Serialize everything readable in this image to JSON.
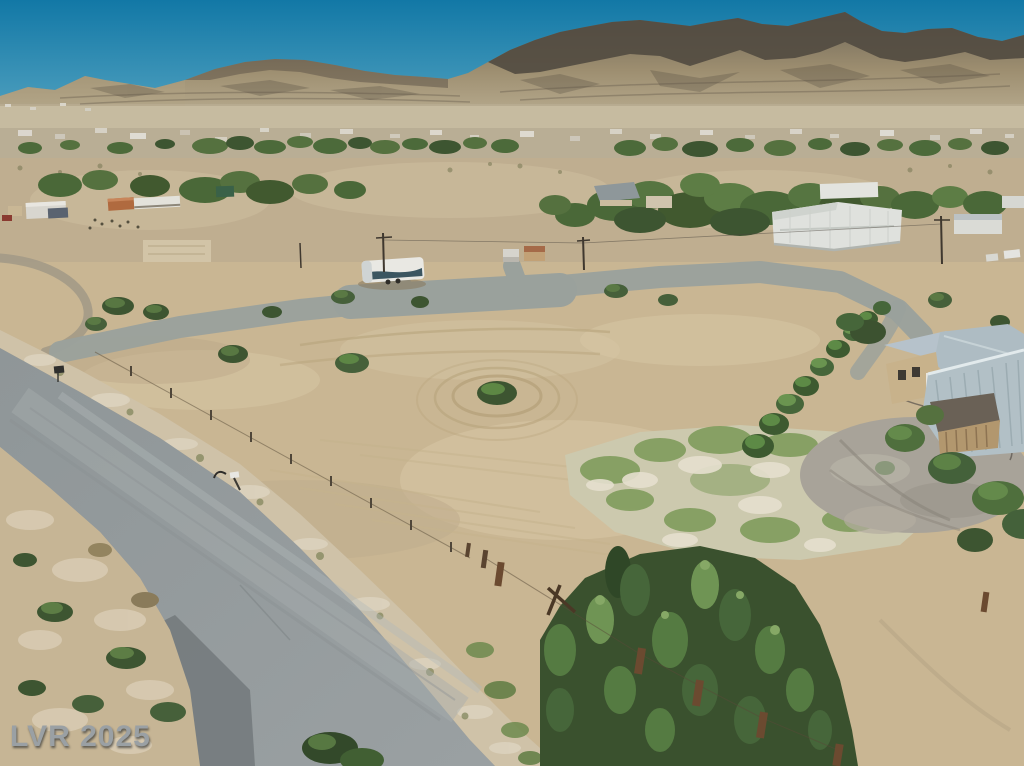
{
  "watermark": {
    "text": "LVR 2025"
  },
  "scene": {
    "colors": {
      "sky-top": "#1278a6",
      "sky-horizon": "#5aa7c3",
      "mountain-top": "#6e6658",
      "mountain-base": "#bdb195",
      "mountain-rock-dark": "#514a40",
      "valley": "#c2b698",
      "town-ground": "#b3a88c",
      "tree-dark": "#3d5531",
      "tree-mid": "#55713f",
      "tree-light": "#6f9254",
      "sand": "#c9b693",
      "sand-light": "#d7c7a6",
      "track": "#b7a37c",
      "pad-gray": "#9aa19c",
      "road": "#9aa0a2",
      "road-dark": "#747b7d",
      "gravel": "#cfc2a8",
      "gravel-light": "#ded5c2",
      "grass": "#7b9a58",
      "grass-ground": "#ccc9ae",
      "rv-white": "#e9e8e3",
      "rv-graphic": "#3b5560",
      "container-rust": "#b06a3f",
      "building-white": "#e0e1dc",
      "warehouse-roof": "#dfe1dd",
      "roof-gray": "#aebcc3",
      "corrugated": "#b2c0c6",
      "wall-tan": "#c8b28b",
      "shed-roof": "#6a6156",
      "shed-wall": "#b2976e",
      "post-brown": "#6b4a30",
      "gravel-yard": "#a8a399",
      "watermark": "#9aa0a4"
    }
  }
}
